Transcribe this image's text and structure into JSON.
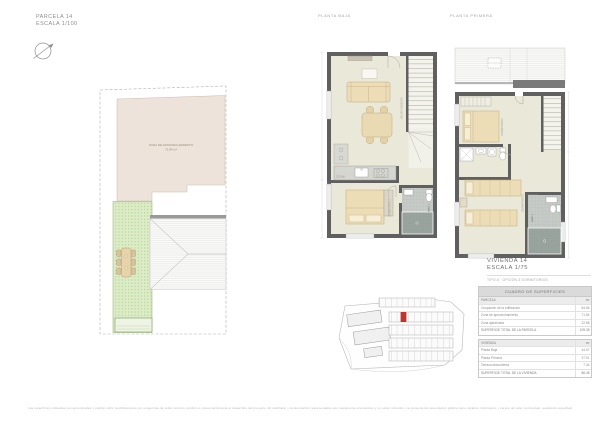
{
  "header": {
    "parcel_title": "PARCELA 14",
    "parcel_scale": "ESCALA 1/100",
    "planta_baja_label": "PLANTA BAJA",
    "planta_primera_label": "PLANTA PRIMERA"
  },
  "parcel_plan": {
    "zone_label": "ZONA DE APROVECHAMIENTO",
    "zone_area": "71.84 m²"
  },
  "dwelling": {
    "title": "VIVIENDA 14",
    "scale": "ESCALA 1/75",
    "subtitle": "TIPO A · OPCIÓN 3 DORMITORIOS"
  },
  "room_labels": {
    "salon": "SALÓN-COMEDOR",
    "cocina": "COCINA",
    "dormitorio1": "DORMITORIO 1",
    "bano1": "BAÑO 1",
    "dormitorio2": "DORMITORIO 2",
    "dormitorio3": "DORMITORIO 3",
    "bano2": "BAÑO 2"
  },
  "surfaces_table": {
    "title": "CUADRO DE SUPERFICIES",
    "rows": [
      {
        "label": "PARCELA",
        "value": "m²"
      },
      {
        "label": "Ocupación de la edificación",
        "value": "84.86"
      },
      {
        "label": "Zona de aprovechamiento",
        "value": "71.84"
      },
      {
        "label": "Zona ajardinada",
        "value": "22.88"
      },
      {
        "label": "SUPERFICIE TOTAL DE LA PARCELA",
        "value": "105.35"
      },
      {
        "label": "VIVIENDA",
        "value": "m²"
      },
      {
        "label": "Planta Baja",
        "value": "44.67"
      },
      {
        "label": "Planta Primera",
        "value": "37.91"
      },
      {
        "label": "Terraza descubierta",
        "value": "7.34"
      },
      {
        "label": "SUPERFICIE TOTAL DE LA VIVIENDA",
        "value": "86.45"
      }
    ]
  },
  "footer": {
    "disclaimer": "Las superficies indicadas son aproximadas y podrán sufrir modificaciones por exigencias de orden técnico, jurídico o comercial durante el desarrollo del proyecto. El mobiliario y la decoración representados son meramente orientativos y no están incluidos. La presente documentación gráfica tiene carácter informativo y carece de valor contractual, quedando supeditada al proyecto de ejecución definitivo y a las licencias correspondientes."
  },
  "colors": {
    "accent_red": "#c3352b",
    "parcel_zone_beige": "#ede3da",
    "garden_green": "#dcecc6",
    "wall_gray": "#606060",
    "floor_cream": "#eae8d8",
    "furniture_tan": "#ecddb7",
    "table_header_gray": "#dadada"
  }
}
